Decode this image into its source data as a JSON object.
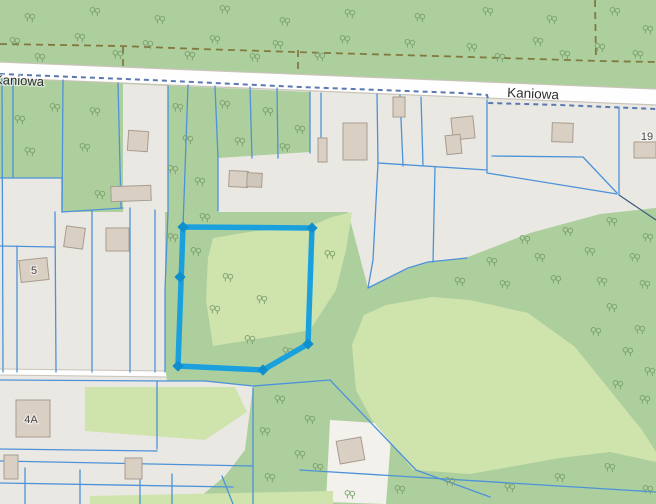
{
  "app": {
    "type": "web-map",
    "description": "Cadastral map viewer showing parcels along Kaniowa street with one selected parcel outlined in blue"
  },
  "labels": [
    {
      "text": "Kaniowa",
      "x": -6,
      "y": 84,
      "rotate": 2.3,
      "size": 13,
      "color": "#2f2f2f",
      "anchor": "start"
    },
    {
      "text": "Kaniowa",
      "x": 507,
      "y": 97,
      "rotate": 2.6,
      "size": 13.5,
      "color": "#2f2f2f",
      "anchor": "start"
    },
    {
      "text": "5",
      "x": 34,
      "y": 274,
      "rotate": 0,
      "size": 11,
      "color": "#4a4a4a",
      "anchor": "middle"
    },
    {
      "text": "4A",
      "x": 31,
      "y": 423,
      "rotate": 0,
      "size": 11,
      "color": "#4a4a4a",
      "anchor": "middle"
    },
    {
      "text": "19",
      "x": 647,
      "y": 140,
      "rotate": 0,
      "size": 11,
      "color": "#4a4a4a",
      "anchor": "middle"
    }
  ],
  "colors": {
    "forest": "#adcf9e",
    "clearing": "#cfe3ad",
    "gray": "#eae8e3",
    "lightParcel": "#f3f1ec",
    "road": "#fefefe",
    "roadCasing": "#c9c3b8",
    "building": "#d9cfc3",
    "buildingStroke": "#a89c90",
    "parcelLine": "#4d92d8",
    "adminDash": "#5b79b0",
    "trackDash": "#7a6a30",
    "darkLine": "#3d5a78",
    "highlight": "#1ba0de",
    "highlightVertex": "#0f8fce",
    "tree": "#7aa06c"
  },
  "geometry": {
    "areas": [
      {
        "name": "base-parcels-area",
        "fill": "gray",
        "pts": "0,0 656,0 656,504 0,504"
      },
      {
        "name": "forest-north-of-road",
        "fill": "forest",
        "pts": "0,0 656,0 656,89 0,62"
      },
      {
        "name": "forest-main",
        "fill": "forest",
        "pts": "0,78 310,92 310,152 218,158 218,212 348,212 368,288 410,268 430,262 468,257 530,233 600,214 656,208 656,504 0,504"
      },
      {
        "name": "gray-parcel-column",
        "fill": "gray",
        "pts": "123,84 168,86 168,212 123,212"
      },
      {
        "name": "gray-parcels-left",
        "fill": "gray",
        "pts": "0,178 62,178 62,212 165,212 165,372 0,372"
      },
      {
        "name": "gray-parcels-southwest",
        "fill": "gray",
        "pts": "0,372 166,372 167,381 205,381 253,386 245,450 225,476 200,497 90,497 90,504 0,504"
      },
      {
        "name": "light-parcel-south",
        "fill": "lightParcel",
        "pts": "330,420 392,424 386,504 326,502"
      },
      {
        "name": "meadow-selected-area",
        "fill": "clearing",
        "pts": "213,238 255,231 308,227 332,217 352,212 346,250 336,290 310,330 294,333 213,346 206,300 208,258"
      },
      {
        "name": "meadow-large-south",
        "fill": "clearing",
        "pts": "386,305 432,297 470,300 528,313 575,347 642,430 656,452 656,462 610,452 560,458 470,474 413,470 372,420 356,390 352,345 364,315"
      },
      {
        "name": "meadow-small-west",
        "fill": "clearing",
        "pts": "85,387 235,387 247,412 205,440 85,431"
      },
      {
        "name": "meadow-bottom-strip",
        "fill": "clearing",
        "pts": "90,496 333,491 333,504 90,504"
      }
    ],
    "road": {
      "pts": "0,62 656,89 656,105 0,78",
      "top": "0,62 656,89",
      "bottom": "0,78 656,105"
    },
    "minor_road": {
      "line": "0,372 166,374"
    },
    "track_paths": [
      "0,44 120,46 200,49 328,53 470,57 600,61 656,62",
      "123,47 123,70",
      "298,50 298,74",
      "595,0 596,60"
    ],
    "admin_dash": "0,74 150,80 300,87 460,93 487,95 489,103 560,105 656,109",
    "parcel_lines": [
      "2,79 3,372",
      "13,79 13,178",
      "63,80 62,212",
      "118,83 121,208",
      "168,86 168,212 165,290 165,372",
      "188,85 183,227",
      "215,86 218,158 218,211",
      "250,87 252,158",
      "277,88 278,158",
      "310,92 310,153",
      "321,93 321,162",
      "377,94 378,163 373,260 368,288",
      "400,95 403,166",
      "421,97 423,165",
      "435,167 433,262",
      "487,100 487,173",
      "619,107 619,195",
      "378,163 487,170",
      "492,156 583,157 617,193",
      "487,173 617,194",
      "368,288 408,268 428,262 467,258",
      "0,178 62,178 62,212 123,208",
      "0,246 55,247",
      "17,246 17,372",
      "55,212 56,372",
      "92,210 92,372",
      "130,208 130,372",
      "155,210 155,372",
      "0,380 166,381 205,381 253,386 330,380",
      "157,381 157,449",
      "0,449 157,451",
      "0,461 253,466",
      "0,483 233,487",
      "253,388 253,504",
      "300,470 656,492",
      "330,380 416,470 490,497",
      "25,468 25,504",
      "80,470 80,504",
      "140,472 140,504",
      "172,474 172,504",
      "222,476 233,504"
    ],
    "dark_lines": [
      "619,195 656,220"
    ],
    "buildings": [
      {
        "x": 128,
        "y": 131,
        "w": 20,
        "h": 20,
        "r": 4
      },
      {
        "x": 111,
        "y": 186,
        "w": 40,
        "h": 15,
        "r": -2
      },
      {
        "x": 229,
        "y": 171,
        "w": 19,
        "h": 16,
        "r": 3
      },
      {
        "x": 247,
        "y": 173,
        "w": 15,
        "h": 14,
        "r": 3,
        "f": "#cfc7bc"
      },
      {
        "x": 65,
        "y": 227,
        "w": 19,
        "h": 21,
        "r": 8
      },
      {
        "x": 106,
        "y": 228,
        "w": 23,
        "h": 23,
        "r": 0
      },
      {
        "x": 20,
        "y": 259,
        "w": 28,
        "h": 22,
        "r": -6
      },
      {
        "x": 16,
        "y": 400,
        "w": 34,
        "h": 37,
        "r": 0
      },
      {
        "x": 452,
        "y": 117,
        "w": 22,
        "h": 22,
        "r": -6
      },
      {
        "x": 446,
        "y": 135,
        "w": 15,
        "h": 19,
        "r": -6
      },
      {
        "x": 552,
        "y": 123,
        "w": 21,
        "h": 19,
        "r": 2
      },
      {
        "x": 393,
        "y": 97,
        "w": 12,
        "h": 20,
        "r": 0
      },
      {
        "x": 343,
        "y": 123,
        "w": 24,
        "h": 37,
        "r": 0
      },
      {
        "x": 318,
        "y": 138,
        "w": 9,
        "h": 24,
        "r": 0
      },
      {
        "x": 634,
        "y": 142,
        "w": 22,
        "h": 16,
        "r": 0
      },
      {
        "x": 338,
        "y": 439,
        "w": 25,
        "h": 23,
        "r": -10
      },
      {
        "x": 4,
        "y": 455,
        "w": 14,
        "h": 24,
        "r": 0
      },
      {
        "x": 125,
        "y": 458,
        "w": 17,
        "h": 21,
        "r": 0
      }
    ],
    "trees": [
      [
        30,
        18
      ],
      [
        95,
        12
      ],
      [
        160,
        20
      ],
      [
        225,
        10
      ],
      [
        285,
        22
      ],
      [
        350,
        14
      ],
      [
        420,
        18
      ],
      [
        488,
        12
      ],
      [
        552,
        20
      ],
      [
        615,
        12
      ],
      [
        648,
        30
      ],
      [
        15,
        42
      ],
      [
        80,
        38
      ],
      [
        148,
        45
      ],
      [
        215,
        40
      ],
      [
        278,
        45
      ],
      [
        345,
        40
      ],
      [
        410,
        44
      ],
      [
        472,
        48
      ],
      [
        538,
        42
      ],
      [
        600,
        48
      ],
      [
        40,
        58
      ],
      [
        118,
        55
      ],
      [
        190,
        56
      ],
      [
        255,
        58
      ],
      [
        320,
        57
      ],
      [
        500,
        58
      ],
      [
        565,
        55
      ],
      [
        638,
        55
      ],
      [
        20,
        120
      ],
      [
        55,
        108
      ],
      [
        95,
        112
      ],
      [
        30,
        152
      ],
      [
        85,
        148
      ],
      [
        100,
        195
      ],
      [
        178,
        108
      ],
      [
        225,
        105
      ],
      [
        268,
        112
      ],
      [
        300,
        130
      ],
      [
        188,
        140
      ],
      [
        240,
        142
      ],
      [
        285,
        148
      ],
      [
        173,
        170
      ],
      [
        200,
        182
      ],
      [
        173,
        238
      ],
      [
        196,
        252
      ],
      [
        205,
        218
      ],
      [
        228,
        278
      ],
      [
        215,
        310
      ],
      [
        250,
        340
      ],
      [
        262,
        300
      ],
      [
        288,
        352
      ],
      [
        330,
        255
      ],
      [
        525,
        240
      ],
      [
        568,
        232
      ],
      [
        612,
        222
      ],
      [
        648,
        238
      ],
      [
        492,
        262
      ],
      [
        540,
        258
      ],
      [
        590,
        252
      ],
      [
        635,
        258
      ],
      [
        460,
        282
      ],
      [
        505,
        285
      ],
      [
        556,
        280
      ],
      [
        602,
        282
      ],
      [
        645,
        285
      ],
      [
        612,
        308
      ],
      [
        640,
        330
      ],
      [
        596,
        332
      ],
      [
        628,
        352
      ],
      [
        650,
        372
      ],
      [
        618,
        385
      ],
      [
        645,
        400
      ],
      [
        560,
        478
      ],
      [
        510,
        488
      ],
      [
        450,
        482
      ],
      [
        400,
        490
      ],
      [
        610,
        468
      ],
      [
        648,
        490
      ],
      [
        350,
        495
      ],
      [
        280,
        400
      ],
      [
        310,
        420
      ],
      [
        265,
        432
      ],
      [
        300,
        455
      ],
      [
        270,
        478
      ],
      [
        318,
        468
      ]
    ],
    "highlight": {
      "pts": "183,227 312,228 308,344 263,370 178,366",
      "vertices": [
        [
          183,
          227
        ],
        [
          312,
          228
        ],
        [
          308,
          344
        ],
        [
          263,
          370
        ],
        [
          178,
          366
        ],
        [
          180,
          277
        ]
      ]
    }
  }
}
